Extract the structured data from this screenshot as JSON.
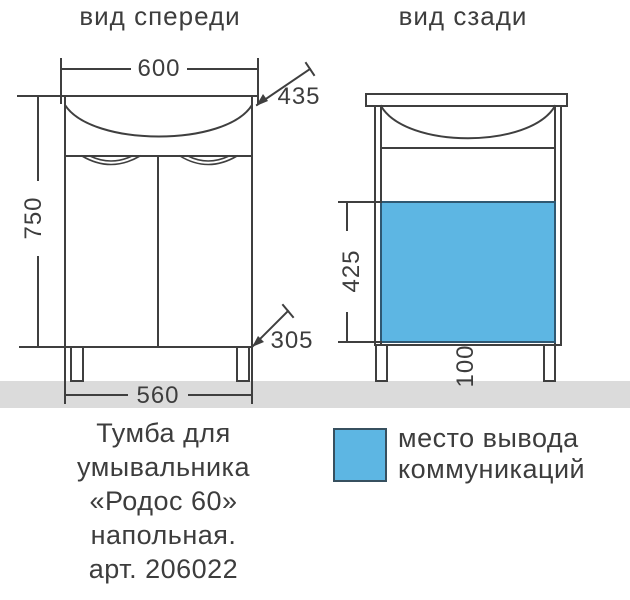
{
  "front_view": {
    "title": "вид спереди",
    "dim_width_top": "600",
    "dim_sink_diag": "435",
    "dim_height": "750",
    "dim_depth_diag": "305",
    "dim_width_bottom": "560"
  },
  "back_view": {
    "title": "вид сзади",
    "dim_cutout_height": "425",
    "dim_cutout_offset": "100"
  },
  "legend": {
    "label_line1": "место вывода",
    "label_line2": "коммуникаций"
  },
  "caption": {
    "line1": "Тумба для",
    "line2": "умывальника",
    "line3": "«Родос 60»",
    "line4": "напольная.",
    "line5": "арт. 206022"
  },
  "colors": {
    "line": "#3f3f3f",
    "text": "#3d3d3d",
    "communication_blue": "#5db6e3",
    "communication_border": "#2f5872",
    "floor_gray": "#dbdbdb"
  }
}
